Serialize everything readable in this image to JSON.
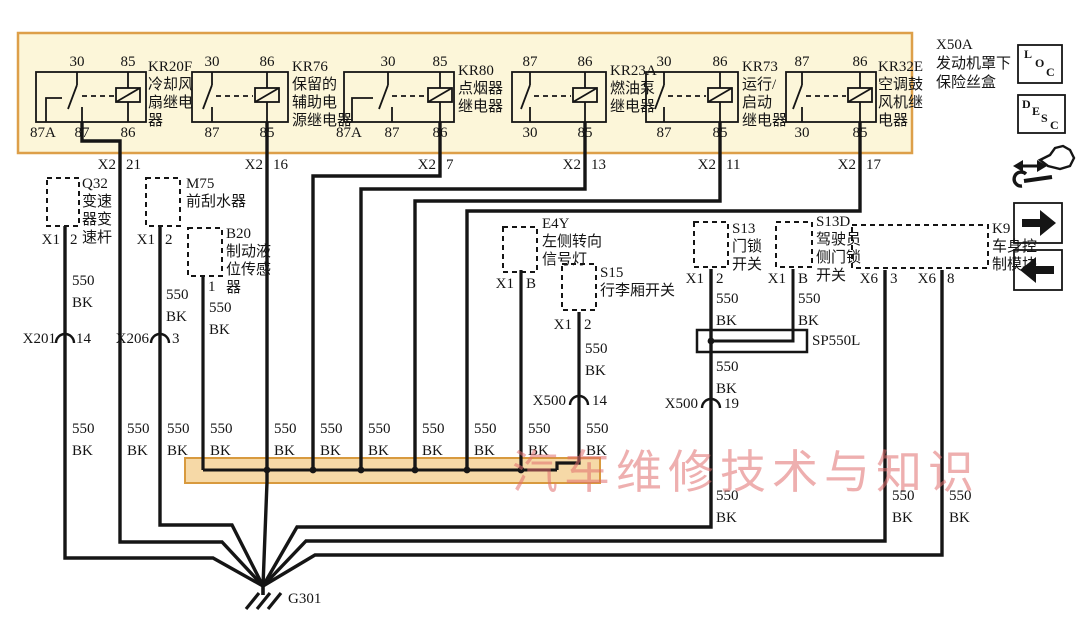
{
  "watermark": "汽车维修技术与知识",
  "fuse_box": {
    "code": "X50A",
    "name_line1": "发动机罩下",
    "name_line2": "保险丝盒",
    "relays": [
      {
        "code": "KR20F",
        "n1": "冷却风",
        "n2": "扇继电",
        "n3": "器",
        "t1": "30",
        "t2": "85",
        "b1": "87A",
        "b2": "87",
        "b3": "86",
        "conn": "X2",
        "pin": "21"
      },
      {
        "code": "KR76",
        "n1": "保留的",
        "n2": "辅助电",
        "n3": "源继电器",
        "t1": "30",
        "t2": "86",
        "b1": "87",
        "b2": "85",
        "conn": "X2",
        "pin": "16"
      },
      {
        "code": "KR80",
        "n1": "点烟器",
        "n2": "继电器",
        "n3": "",
        "t1": "30",
        "t2": "85",
        "b1": "87A",
        "b2": "87",
        "b3": "86",
        "conn": "X2",
        "pin": "7"
      },
      {
        "code": "KR23A",
        "n1": "燃油泵",
        "n2": "继电器",
        "n3": "",
        "t1": "87",
        "t2": "86",
        "b1": "30",
        "b2": "85",
        "conn": "X2",
        "pin": "13"
      },
      {
        "code": "KR73",
        "n1": "运行/",
        "n2": "启动",
        "n3": "继电器",
        "t1": "30",
        "t2": "86",
        "b1": "87",
        "b2": "85",
        "conn": "X2",
        "pin": "11"
      },
      {
        "code": "KR32E",
        "n1": "空调鼓",
        "n2": "风机继",
        "n3": "电器",
        "t1": "87",
        "t2": "86",
        "b1": "30",
        "b2": "85",
        "conn": "X2",
        "pin": "17"
      }
    ]
  },
  "components": {
    "q32": {
      "code": "Q32",
      "n1": "变速",
      "n2": "器变",
      "n3": "速杆",
      "conn": "X1",
      "pin": "2"
    },
    "m75": {
      "code": "M75",
      "n1": "前刮水器",
      "conn": "X1",
      "pin": "2"
    },
    "b20": {
      "code": "B20",
      "n1": "制动液",
      "n2": "位传感",
      "n3": "器",
      "pin": "1"
    },
    "e4y": {
      "code": "E4Y",
      "n1": "左侧转向",
      "n2": "信号灯",
      "conn": "X1",
      "pin": "B"
    },
    "s15": {
      "code": "S15",
      "n1": "行李厢开关",
      "conn": "X1",
      "pin": "2"
    },
    "s13": {
      "code": "S13",
      "n1": "门锁",
      "n2": "开关",
      "conn": "X1",
      "pin": "2"
    },
    "s13d": {
      "code": "S13D",
      "n1": "驾驶员",
      "n2": "侧门锁",
      "n3": "开关",
      "conn": "X1",
      "pin": "B"
    },
    "k9": {
      "code": "K9",
      "n1": "车身控",
      "n2": "制模块",
      "conn1": "X6",
      "pin1": "3",
      "conn2": "X6",
      "pin2": "8"
    }
  },
  "connectors": {
    "x201": {
      "code": "X201",
      "pin": "14"
    },
    "x206": {
      "code": "X206",
      "pin": "3"
    },
    "x500a": {
      "code": "X500",
      "pin": "14"
    },
    "x500b": {
      "code": "X500",
      "pin": "19"
    }
  },
  "splice": {
    "code": "SP550L"
  },
  "ground": {
    "code": "G301"
  },
  "wire": {
    "spec": "550",
    "color": "BK"
  },
  "icons": {
    "loc": [
      "L",
      "O",
      "C"
    ],
    "desc": [
      "D",
      "E",
      "S",
      "C"
    ]
  },
  "colors": {
    "wire": "#151515",
    "box_fill": "#fcf6d9",
    "box_border": "#dd9f49",
    "bus_fill": "#f6d9a7",
    "watermark": "#e07878"
  }
}
